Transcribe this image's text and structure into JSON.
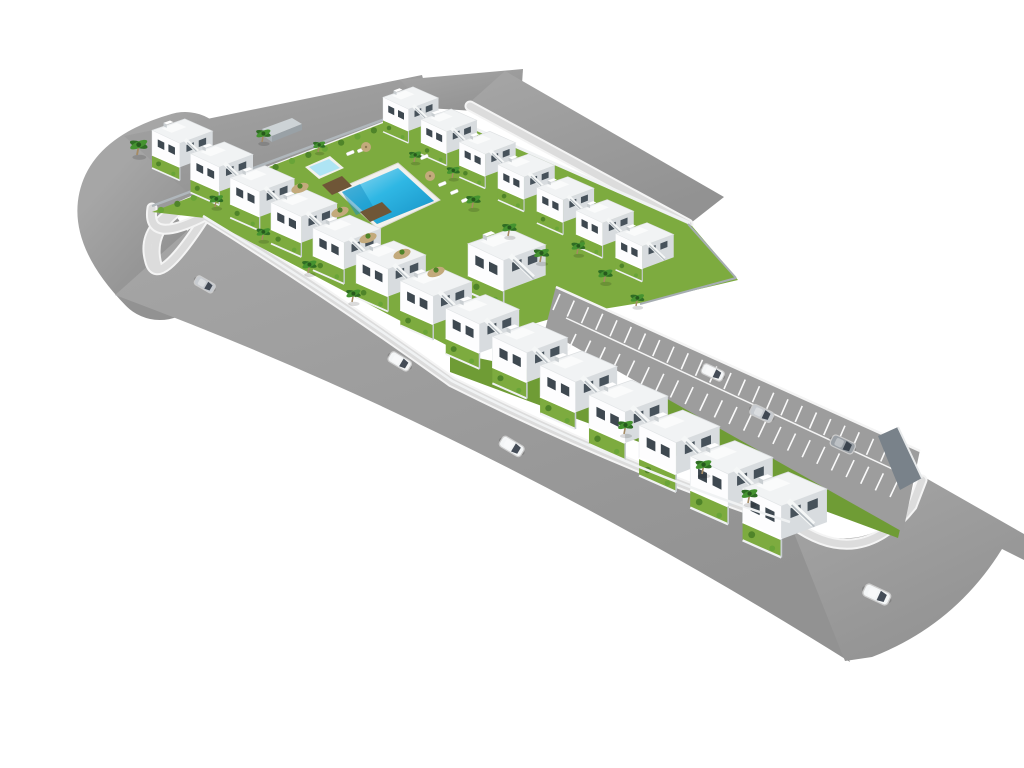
{
  "scene": {
    "title": "aerial-render-residential-complex",
    "description": "3D aerial rendering of a white townhouse development with central lawn courtyard, swimming pool, perimeter road and parking lane",
    "background": "#ffffff"
  },
  "colors": {
    "road": "#a6a6a6",
    "roadDark": "#929292",
    "sidewalk": "#dcdcdc",
    "curb": "#f4f4f4",
    "grass": "#7dab3f",
    "grassDark": "#6f9c35",
    "hedge": "#4f8429",
    "bushLight": "#69a438",
    "palmDark": "#2f6d24",
    "palmLight": "#459330",
    "trunk": "#a58a63",
    "poolDeck": "#f2f1ed",
    "water": "#2fb7e4",
    "waterLight": "#a5def2",
    "waterDeep": "#1590c4",
    "coping": "#ccb78d",
    "kidsWater": "#aee4f4",
    "wood": "#6f5637",
    "bldgTop": "#f1f3f4",
    "bldgFace": "#fdfdfe",
    "bldgSide": "#d8dcdf",
    "window": "#3e4850",
    "windowSide": "#47525b",
    "stair": "#f5f7f7",
    "stairShadow": "#b6bdc2",
    "wallWhite": "#f0f2f3",
    "wallGray": "#a6adb2",
    "fence": "#b0b7bc",
    "shed": "#aab2b7",
    "shedTop": "#cdd3d6",
    "stripe": "#fafafa",
    "parkBase": "#9d9d9d",
    "endWall": "#79828a",
    "carWhite": "#f4f6f7",
    "carSilver": "#c7cbd0",
    "carGray": "#9aa0a6",
    "glass": "#323b46",
    "gravel": "#c3aa7c",
    "shadow": "rgba(0,0,0,0.14)"
  },
  "complex": {
    "front_row": {
      "count": 14,
      "x0": 152,
      "y0": 118,
      "step_x": 38.5,
      "step_y": 23,
      "growth": 0.03,
      "scale0": 0.82
    },
    "top_row": {
      "count": 7,
      "x0": 383,
      "y0": 86,
      "step_x": 38,
      "step_y": 22.2,
      "growth": 0.008,
      "scale0": 0.75
    },
    "center_building": {
      "x": 468,
      "y": 228,
      "scale": 1.05
    }
  },
  "parking": {
    "upper_stripes": 24,
    "lower_stripes": 22
  },
  "cars": [
    {
      "id": "car-road-1",
      "x": 205,
      "y": 284,
      "angle": 30,
      "scale": 0.85,
      "color": "carSilver"
    },
    {
      "id": "car-road-2",
      "x": 400,
      "y": 361,
      "angle": 31,
      "scale": 0.95,
      "color": "carWhite"
    },
    {
      "id": "car-road-3",
      "x": 512,
      "y": 446,
      "angle": 31,
      "scale": 1.0,
      "color": "carWhite"
    },
    {
      "id": "car-road-4",
      "x": 877,
      "y": 594,
      "angle": 25,
      "scale": 1.1,
      "color": "carWhite"
    },
    {
      "id": "car-parking-1",
      "x": 713,
      "y": 372,
      "angle": 25,
      "scale": 0.92,
      "color": "carWhite"
    },
    {
      "id": "car-parking-2",
      "x": 762,
      "y": 413,
      "angle": 25,
      "scale": 0.95,
      "color": "carSilver"
    },
    {
      "id": "car-parking-3",
      "x": 843,
      "y": 444,
      "angle": 25,
      "scale": 1.0,
      "color": "carGray"
    }
  ],
  "palms": [
    {
      "x": 137,
      "y": 155,
      "s": 1.15
    },
    {
      "x": 262,
      "y": 142,
      "s": 0.95
    },
    {
      "x": 318,
      "y": 152,
      "s": 0.8
    },
    {
      "x": 215,
      "y": 207,
      "s": 0.9
    },
    {
      "x": 262,
      "y": 240,
      "s": 0.9
    },
    {
      "x": 308,
      "y": 273,
      "s": 0.95
    },
    {
      "x": 352,
      "y": 302,
      "s": 0.95
    },
    {
      "x": 414,
      "y": 162,
      "s": 0.8
    },
    {
      "x": 452,
      "y": 178,
      "s": 0.85
    },
    {
      "x": 472,
      "y": 208,
      "s": 0.95
    },
    {
      "x": 508,
      "y": 236,
      "s": 0.95
    },
    {
      "x": 540,
      "y": 262,
      "s": 1.0
    },
    {
      "x": 577,
      "y": 254,
      "s": 0.9
    },
    {
      "x": 604,
      "y": 282,
      "s": 0.95
    },
    {
      "x": 636,
      "y": 306,
      "s": 0.9
    },
    {
      "x": 624,
      "y": 434,
      "s": 1.0
    },
    {
      "x": 702,
      "y": 474,
      "s": 1.05
    },
    {
      "x": 748,
      "y": 503,
      "s": 1.05
    }
  ],
  "gravel_patches": [
    {
      "x": 368,
      "y": 238
    },
    {
      "x": 402,
      "y": 254
    },
    {
      "x": 340,
      "y": 212
    },
    {
      "x": 300,
      "y": 188
    },
    {
      "x": 436,
      "y": 272
    }
  ],
  "loungers": [
    {
      "x": 346,
      "y": 153
    },
    {
      "x": 357,
      "y": 150
    },
    {
      "x": 420,
      "y": 157
    },
    {
      "x": 438,
      "y": 184
    },
    {
      "x": 450,
      "y": 192
    },
    {
      "x": 461,
      "y": 200
    }
  ],
  "umbrellas": [
    {
      "x": 430,
      "y": 176
    },
    {
      "x": 366,
      "y": 147
    }
  ]
}
